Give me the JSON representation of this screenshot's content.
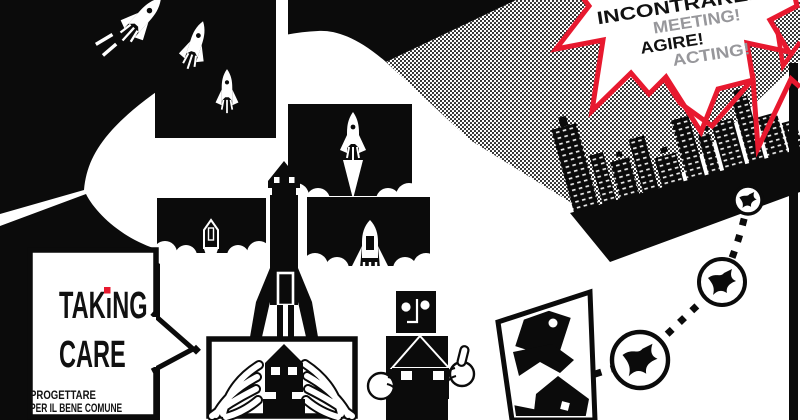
{
  "poster": {
    "burst": {
      "line1": "INCONTRARE!",
      "line2": "MEETING!",
      "line3": "AGIRE!",
      "line4": "ACTING!",
      "border_color": "#e8192f",
      "primary_text_color": "#111111",
      "secondary_text_color": "#97979b"
    },
    "logo_bubble": {
      "word1_pre": "TAK",
      "word1_i": "ı",
      "word1_post": "NG",
      "word2": "CARE",
      "i_dot_color": "#e8192f",
      "tagline1": "PROGETTARE",
      "tagline2": "PER IL BENE COMUNE",
      "text_color": "#111111"
    },
    "colors": {
      "ink": "#0b0b0b",
      "paper": "#ffffff",
      "red": "#e8192f",
      "gray": "#97979b"
    },
    "icons": [
      "rocket-icon",
      "launch-panel-icon",
      "house-rocket-icon",
      "worried-house-figure-icon",
      "robot-holding-house-icon",
      "city-skyline-icon",
      "bird-badge-icon",
      "falling-house-shapes-icon",
      "halftone-band",
      "speech-bubble",
      "starburst-bubble",
      "dotted-path"
    ]
  }
}
